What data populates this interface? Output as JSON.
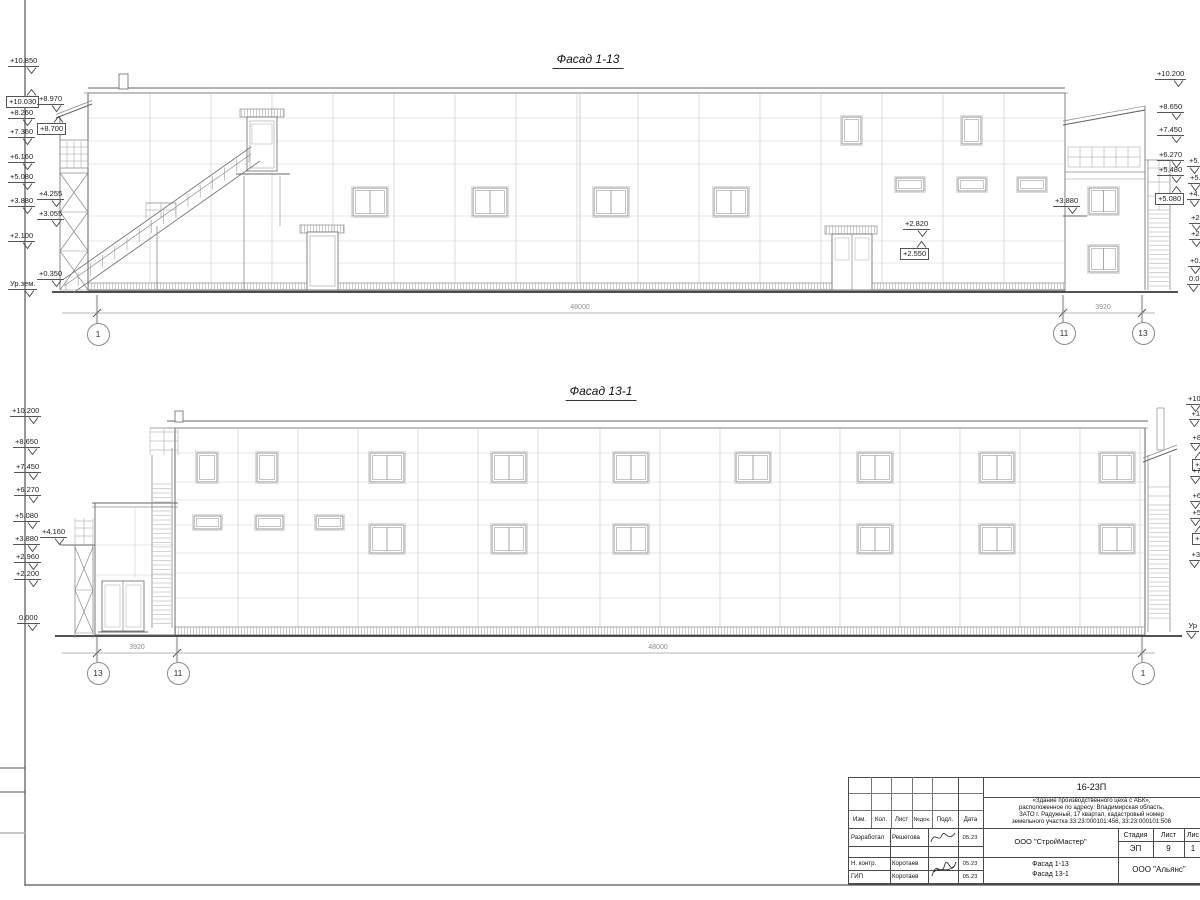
{
  "facade_top": {
    "title": "Фасад 1-13",
    "marks_left": [
      {
        "label": "+10.850",
        "x": 8,
        "y": 57
      },
      {
        "label": "+10.030",
        "x": 6,
        "y": 89,
        "boxed": true,
        "up": true
      },
      {
        "label": "+8.970",
        "x": 37,
        "y": 95
      },
      {
        "label": "+8.260",
        "x": 8,
        "y": 109
      },
      {
        "label": "+8.700",
        "x": 37,
        "y": 116,
        "boxed": true,
        "up": true
      },
      {
        "label": "+7.360",
        "x": 8,
        "y": 128
      },
      {
        "label": "+6.160",
        "x": 8,
        "y": 153
      },
      {
        "label": "+5.080",
        "x": 8,
        "y": 173
      },
      {
        "label": "+4.255",
        "x": 37,
        "y": 190
      },
      {
        "label": "+3.880",
        "x": 8,
        "y": 197
      },
      {
        "label": "+3.055",
        "x": 37,
        "y": 210
      },
      {
        "label": "+2.100",
        "x": 8,
        "y": 232
      },
      {
        "label": "+0.350",
        "x": 37,
        "y": 270
      },
      {
        "label": "Ур.зем.",
        "x": 8,
        "y": 280
      }
    ],
    "marks_right": [
      {
        "label": "+10.200",
        "x": 1155,
        "y": 70
      },
      {
        "label": "+8.650",
        "x": 1157,
        "y": 103
      },
      {
        "label": "+7.450",
        "x": 1157,
        "y": 126
      },
      {
        "label": "+6.270",
        "x": 1157,
        "y": 151
      },
      {
        "label": "+5.480",
        "x": 1157,
        "y": 166
      },
      {
        "label": "+5.080",
        "x": 1155,
        "y": 186,
        "boxed": true,
        "up": true
      }
    ],
    "marks_right2": [
      {
        "label": "+5.",
        "x": 1187,
        "y": 157
      },
      {
        "label": "+5.",
        "x": 1188,
        "y": 174
      },
      {
        "label": "+4.",
        "x": 1187,
        "y": 190
      },
      {
        "label": "+2.",
        "x": 1189,
        "y": 214
      },
      {
        "label": "+2.",
        "x": 1189,
        "y": 230
      },
      {
        "label": "+0.",
        "x": 1188,
        "y": 257
      },
      {
        "label": "0.0",
        "x": 1187,
        "y": 275
      }
    ],
    "marks_inner": [
      {
        "label": "+2.820",
        "x": 903,
        "y": 220
      },
      {
        "label": "+2.550",
        "x": 900,
        "y": 241,
        "boxed": true,
        "up": true
      },
      {
        "label": "+3.880",
        "x": 1053,
        "y": 197
      }
    ],
    "dim_labels": [
      {
        "label": "48000",
        "x": 580,
        "y": 304
      },
      {
        "label": "3920",
        "x": 1103,
        "y": 304
      }
    ],
    "axes": [
      {
        "label": "1",
        "x": 97,
        "y": 333
      },
      {
        "label": "11",
        "x": 1063,
        "y": 332
      },
      {
        "label": "13",
        "x": 1142,
        "y": 332
      }
    ]
  },
  "facade_bottom": {
    "title": "Фасад 13-1",
    "marks_left": [
      {
        "label": "+10.200",
        "x": 10,
        "y": 407
      },
      {
        "label": "+8.650",
        "x": 13,
        "y": 438
      },
      {
        "label": "+7.450",
        "x": 14,
        "y": 463
      },
      {
        "label": "+6.270",
        "x": 14,
        "y": 486
      },
      {
        "label": "+5.080",
        "x": 13,
        "y": 512
      },
      {
        "label": "+4.160",
        "x": 40,
        "y": 528
      },
      {
        "label": "+3.880",
        "x": 13,
        "y": 535
      },
      {
        "label": "+2.960",
        "x": 14,
        "y": 553
      },
      {
        "label": "+2.200",
        "x": 14,
        "y": 570
      },
      {
        "label": "0.000",
        "x": 17,
        "y": 614
      }
    ],
    "marks_right2": [
      {
        "label": "+10",
        "x": 1186,
        "y": 395
      },
      {
        "label": "+1",
        "x": 1189,
        "y": 410
      },
      {
        "label": "+8",
        "x": 1190,
        "y": 434
      },
      {
        "label": "+8",
        "x": 1192,
        "y": 452,
        "boxed": true,
        "up": true
      },
      {
        "label": "+7",
        "x": 1190,
        "y": 467
      },
      {
        "label": "+6",
        "x": 1190,
        "y": 492
      },
      {
        "label": "+5",
        "x": 1190,
        "y": 509
      },
      {
        "label": "+5",
        "x": 1192,
        "y": 526,
        "boxed": true,
        "up": true
      },
      {
        "label": "+3",
        "x": 1189,
        "y": 551
      },
      {
        "label": "Ур",
        "x": 1186,
        "y": 622
      }
    ],
    "dim_labels": [
      {
        "label": "3920",
        "x": 137,
        "y": 644
      },
      {
        "label": "48000",
        "x": 658,
        "y": 644
      }
    ],
    "axes": [
      {
        "label": "13",
        "x": 97,
        "y": 672
      },
      {
        "label": "11",
        "x": 177,
        "y": 672
      },
      {
        "label": "1",
        "x": 1142,
        "y": 672
      }
    ]
  },
  "titleblock": {
    "doc_number": "16-23П",
    "description_lines": [
      "«Здание производственного цеха с АБК»,",
      "расположенное по адресу: Владимирская область,",
      "ЗАТО г. Радужный, 17 квартал, кадастровый номер",
      "земельного участка 33:23:000101:456, 33:23:000101:508"
    ],
    "header_cols": [
      "Изм.",
      "Кол.",
      "Лист",
      "№док.",
      "Подл.",
      "Дата"
    ],
    "rows": [
      {
        "role": "Разработал",
        "name": "Решетова",
        "date": "05.23"
      },
      {
        "role": "Н. контр.",
        "name": "Коротаев",
        "date": "05.23"
      },
      {
        "role": "ГИП",
        "name": "Коротаев",
        "date": "05.23"
      }
    ],
    "org": "ООО \"СтройМастер\"",
    "project_lines": [
      "Фасад 1-13",
      "Фасад 13-1"
    ],
    "stage_label": "Стадия",
    "sheet_label": "Лист",
    "sheets_label": "Лис",
    "stage": "ЭП",
    "sheet_no": "9",
    "sheets_no": "1",
    "contractor": "ООО \"Альянс\""
  }
}
